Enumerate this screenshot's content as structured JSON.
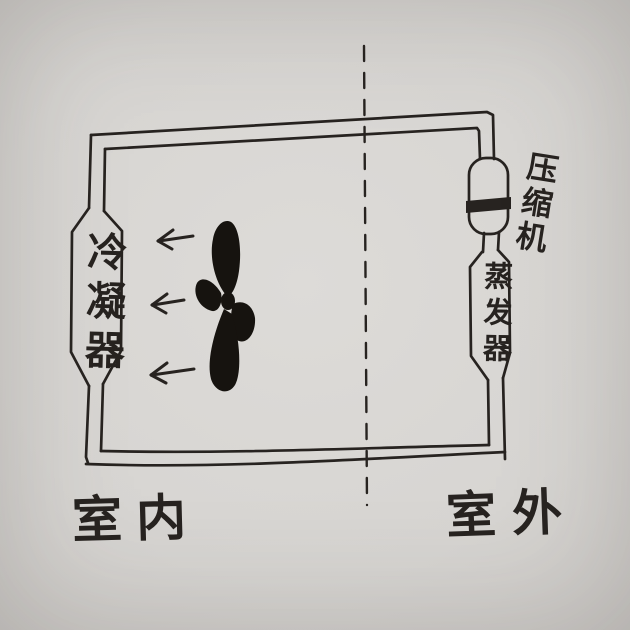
{
  "diagram": {
    "labels": {
      "condenser": "冷凝器",
      "compressor": "压缩机",
      "evaporator": "蒸发器",
      "indoor": "室内",
      "outdoor": "室外"
    },
    "icons": {
      "fan": "fan-icon",
      "airflow_arrow": "left-arrow-icon",
      "boundary_line": "dashed-divider-line",
      "piston_band": "compressor-piston-band"
    },
    "airflow": {
      "arrow_glyph": "←",
      "arrow_count": 3,
      "direction": "left"
    },
    "colors": {
      "ink": "#272320",
      "fan_ink": "#16130f",
      "paper": "#d8d6d3"
    }
  }
}
